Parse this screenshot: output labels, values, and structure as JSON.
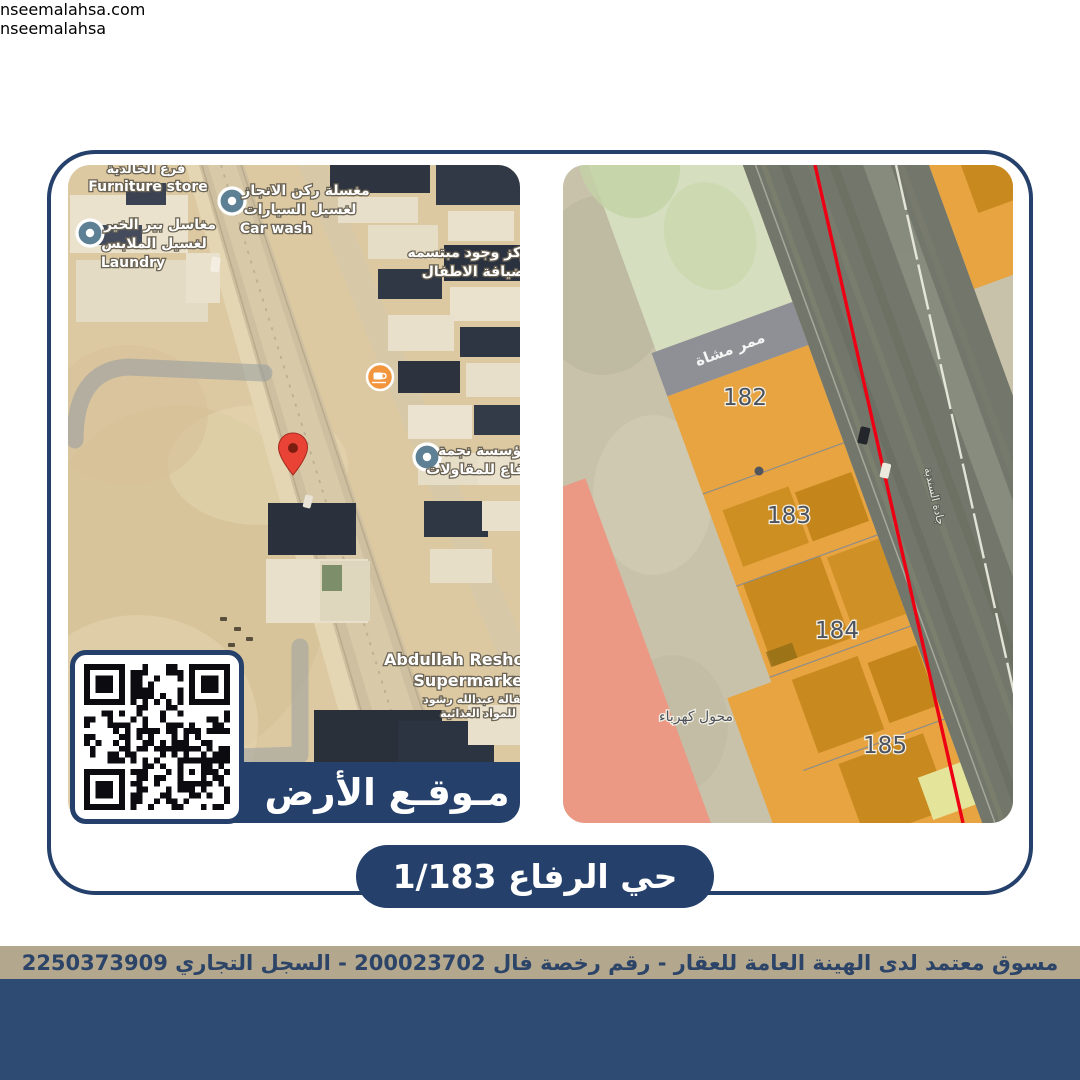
{
  "colors": {
    "navy": "#24406b",
    "navy_band": "#2e4b73",
    "tan": "#b3a78e",
    "sand": "#dcc9a2",
    "parcel_orange": "#e7a440",
    "zone_green": "#d5dfbf",
    "zone_pink": "#ec9d88",
    "road_red_line": "#ee0014",
    "marker_red": "#e94335",
    "pin_teal": "#5d8095",
    "cafe_orange": "#f2953c"
  },
  "left_map": {
    "banner": "مـوقـع الأرض",
    "labels": {
      "furniture_ar": "فرع الخالدية",
      "furniture_en": "Furniture store",
      "carwash_ar1": "مغسلة ركن الانجاز",
      "carwash_ar2": "لغسيل السيارات",
      "carwash_en": "Car wash",
      "laundry_ar1": "مغاسل بير الخير",
      "laundry_ar2": "لغسيل الملابس",
      "laundry_en": "Laundry",
      "kids_ar1": "مركز وجود مبتسمه",
      "kids_ar2": "لضيافة الاطفال",
      "najma_ar1": "مؤسسة نجمة",
      "najma_ar2": "لرفاع للمقاولات",
      "market_en1": "Abdullah Reshod",
      "market_en2": "Supermarket",
      "market_ar1": "بقالة عبدالله رشود",
      "market_ar2": "للمواد الغذائية"
    }
  },
  "right_map": {
    "parcels": [
      "182",
      "183",
      "184",
      "185"
    ],
    "walkway": "ممر مشاة",
    "transformer": "محول كهرباء",
    "street": "جادة السندية"
  },
  "title_pill": "حي الرفاع 1/183",
  "license_bar": "مسوق معتمد لدى الهينة العامة للعقار - رقم رخصة فال 200023702 - السجل التجاري 2250373909",
  "footer": {
    "website": "nseemalahsa.com",
    "social_handle": "nseemalahsa",
    "phone1": "0594977277",
    "phone2": "0581771188"
  },
  "icons": {
    "tiktok_glyph": "♪"
  }
}
